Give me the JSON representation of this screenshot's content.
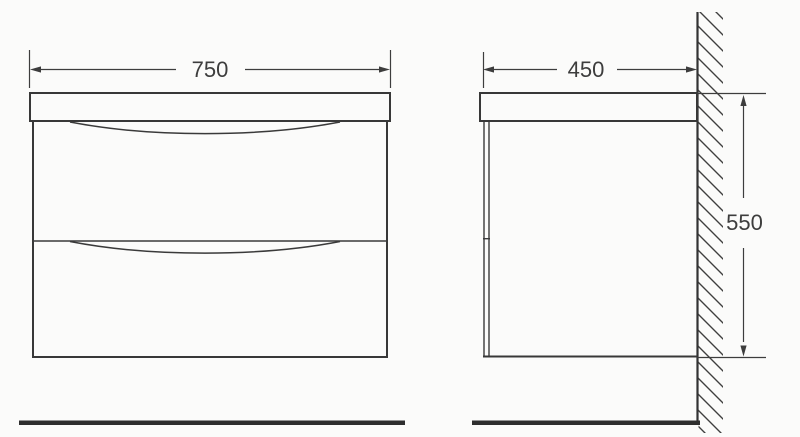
{
  "drawing": {
    "kind": "technical-dimension-drawing",
    "colors": {
      "background": "#fbfbfa",
      "outline": "#383838",
      "dimension_line": "#3d3d3d",
      "hatch": "#3f3f3f",
      "floor": "#2e2e2e"
    },
    "front_view": {
      "width_dimension": "750"
    },
    "side_view": {
      "depth_dimension": "450",
      "height_dimension": "550"
    }
  }
}
